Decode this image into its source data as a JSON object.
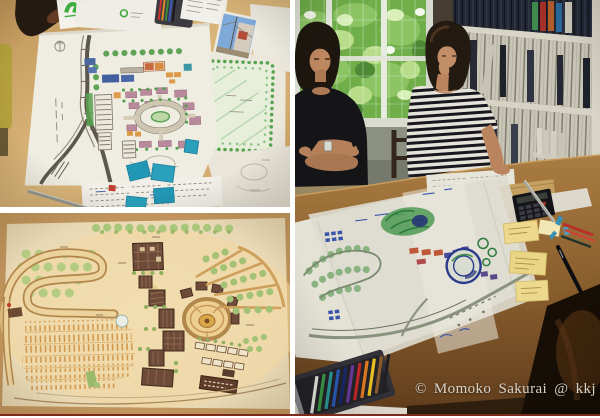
{
  "page": {
    "background": "#ffffff",
    "divider_color": "#7b2a1b",
    "gap_color": "#ffffff"
  },
  "caption": {
    "text": "© Momoko Sakurai @ kkj",
    "color": "#d8d4cb"
  },
  "photos": {
    "top_left": {
      "label": "Hand-drawn colored site plan sheets spread on a light wooden table with blue sticky notes, colored pencils, a green-logo flyer and a reference street photo"
    },
    "bottom_left": {
      "label": "Hand-colored landscape master plan on cream paper with orchard loop road, striped parking rows, dark hatched buildings, circular plaza and tree wedges"
    },
    "right": {
      "label": "Two women seated at a work table covered with a large blue and green marker site plan, in front of a garden window and a full bookshelf, with sticky notes, calculator and a box of colored pencils"
    }
  }
}
